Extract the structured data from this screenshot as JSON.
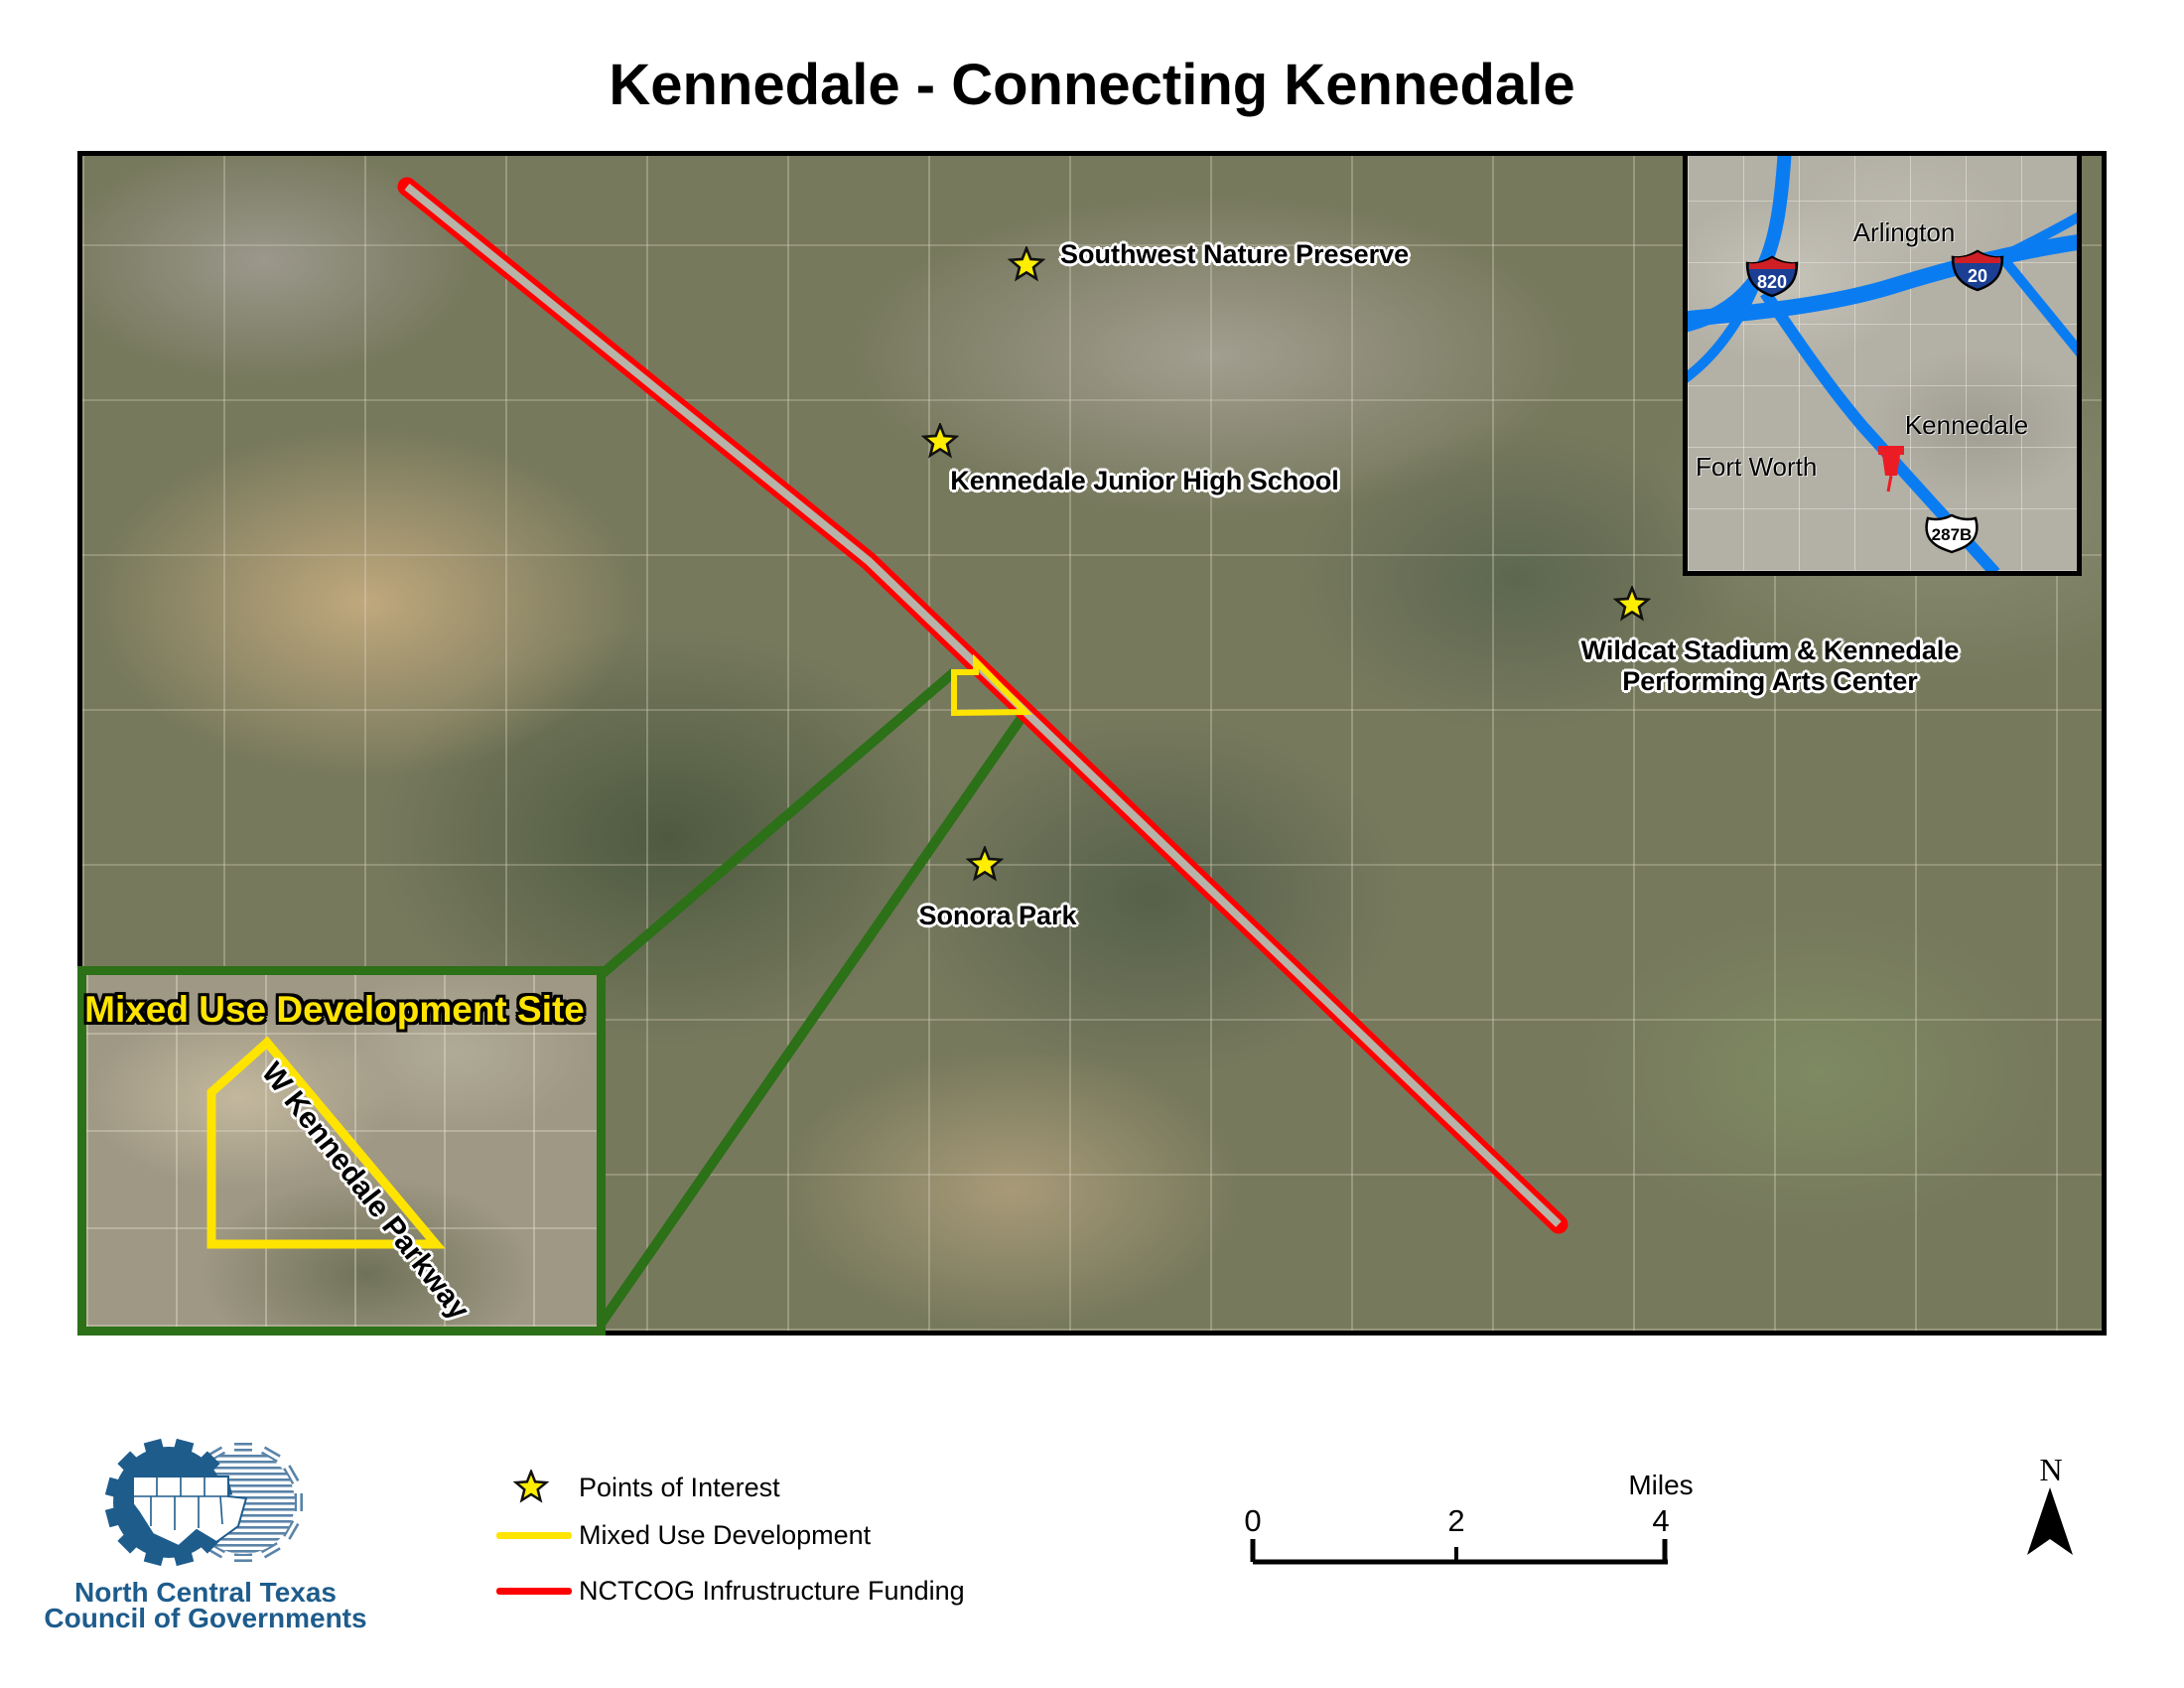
{
  "title": "Kennedale - Connecting Kennedale",
  "map": {
    "poi": [
      {
        "label": "Southwest Nature Preserve"
      },
      {
        "label": "Kennedale Junior High School"
      },
      {
        "label_line1": "Wildcat Stadium & Kennedale",
        "label_line2": "Performing Arts Center"
      },
      {
        "label": "Sonora Park"
      }
    ]
  },
  "region_inset": {
    "city_arlington": "Arlington",
    "city_fort_worth": "Fort Worth",
    "city_kennedale": "Kennedale",
    "shield_820": "820",
    "shield_20": "20",
    "shield_287b": "287B"
  },
  "site_inset": {
    "title": "Mixed Use Development Site",
    "road_label": "W Kennedale Parkway"
  },
  "legend": {
    "items": [
      {
        "label": "Points of Interest"
      },
      {
        "label": "Mixed Use Development"
      },
      {
        "label": "NCTCOG Infrustructure Funding"
      }
    ]
  },
  "scalebar": {
    "tick0": "0",
    "tick2": "2",
    "tick4": "4",
    "unit": "Miles"
  },
  "north_label": "N",
  "logo": {
    "line1": "North Central Texas",
    "line2": "Council of Governments"
  },
  "colors": {
    "poi_star": "#ffee00",
    "mixed_use": "#ffe400",
    "funding_line": "#ff0000",
    "callout_green": "#2c7018",
    "highway_blue": "#0a7cf2",
    "logo_blue": "#1e5c8c"
  }
}
